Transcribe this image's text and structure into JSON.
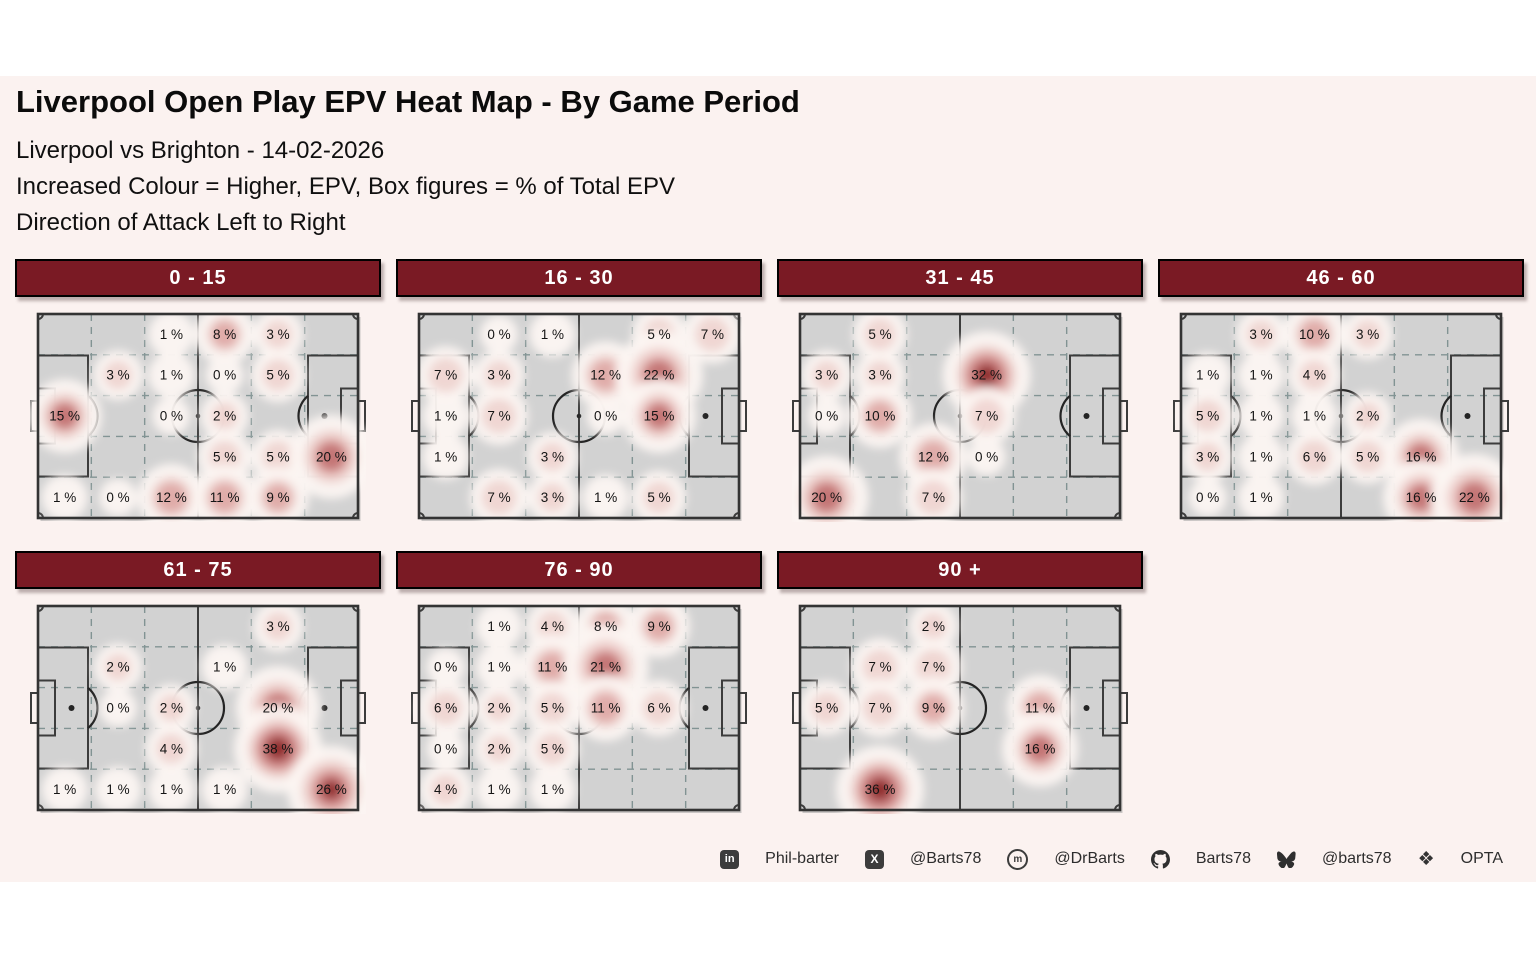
{
  "colors": {
    "page_bg": "#ffffff",
    "figure_bg": "#fbf2f0",
    "header_bar_bg": "#7a1a24",
    "header_bar_border": "#000000",
    "header_text": "#ffffff",
    "pitch_fill": "#d2d2d2",
    "pitch_border": "#333333",
    "pitch_marking": "#3c3c3c",
    "center_circle": "#242424",
    "grid_line": "#7d9090",
    "label_text": "#141414",
    "heat_halo": "#fcf5f2",
    "heat_light": "#edcfcc",
    "heat_mid": "#dda5a2",
    "heat_strong": "#c17070",
    "heat_core": "#8f2b2b"
  },
  "header": {
    "title": "Liverpool Open Play EPV Heat Map - By Game Period",
    "subtitle_lines": [
      "Liverpool vs Brighton - 14-02-2026",
      "Increased Colour = Higher, EPV, Box figures = % of Total EPV",
      "Direction of Attack Left to Right"
    ]
  },
  "chart_data": {
    "type": "heatmap",
    "unit": "% of Total EPV",
    "grid": {
      "cols": 6,
      "rows": 5
    },
    "direction_of_attack": "left to right",
    "panels": [
      {
        "period": "0 - 15",
        "cells": [
          [
            null,
            null,
            1,
            8,
            3,
            null
          ],
          [
            null,
            3,
            1,
            0,
            5,
            null
          ],
          [
            15,
            null,
            0,
            2,
            null,
            null
          ],
          [
            null,
            null,
            null,
            5,
            5,
            20
          ],
          [
            1,
            0,
            12,
            11,
            9,
            null
          ]
        ]
      },
      {
        "period": "16 - 30",
        "cells": [
          [
            null,
            0,
            1,
            null,
            5,
            7
          ],
          [
            7,
            3,
            null,
            12,
            22,
            null
          ],
          [
            1,
            7,
            null,
            0,
            15,
            null
          ],
          [
            1,
            null,
            3,
            null,
            null,
            null
          ],
          [
            null,
            7,
            3,
            1,
            5,
            null
          ]
        ]
      },
      {
        "period": "31 - 45",
        "cells": [
          [
            null,
            5,
            null,
            null,
            null,
            null
          ],
          [
            3,
            3,
            null,
            32,
            null,
            null
          ],
          [
            0,
            10,
            null,
            7,
            null,
            null
          ],
          [
            null,
            null,
            12,
            0,
            null,
            null
          ],
          [
            20,
            null,
            7,
            null,
            null,
            null
          ]
        ]
      },
      {
        "period": "46 - 60",
        "cells": [
          [
            null,
            3,
            10,
            3,
            null,
            null
          ],
          [
            1,
            1,
            4,
            null,
            null,
            null
          ],
          [
            5,
            1,
            1,
            2,
            null,
            null
          ],
          [
            3,
            1,
            6,
            5,
            16,
            null
          ],
          [
            0,
            1,
            null,
            null,
            16,
            22
          ]
        ]
      },
      {
        "period": "61 - 75",
        "cells": [
          [
            null,
            null,
            null,
            null,
            3,
            null
          ],
          [
            null,
            2,
            null,
            1,
            null,
            null
          ],
          [
            null,
            0,
            2,
            null,
            20,
            null
          ],
          [
            null,
            null,
            4,
            null,
            38,
            null
          ],
          [
            1,
            1,
            1,
            1,
            null,
            26
          ]
        ]
      },
      {
        "period": "76 - 90",
        "cells": [
          [
            null,
            1,
            4,
            8,
            9,
            null
          ],
          [
            0,
            1,
            11,
            21,
            null,
            null
          ],
          [
            6,
            2,
            5,
            11,
            6,
            null
          ],
          [
            0,
            2,
            5,
            null,
            null,
            null
          ],
          [
            4,
            1,
            1,
            null,
            null,
            null
          ]
        ]
      },
      {
        "period": "90 +",
        "cells": [
          [
            null,
            null,
            2,
            null,
            null,
            null
          ],
          [
            null,
            7,
            7,
            null,
            null,
            null
          ],
          [
            5,
            7,
            9,
            null,
            11,
            null
          ],
          [
            null,
            null,
            null,
            null,
            16,
            null
          ],
          [
            null,
            36,
            null,
            null,
            null,
            null
          ]
        ]
      }
    ]
  },
  "footer": {
    "items": [
      {
        "icon": "linkedin-icon",
        "label": "Phil-barter"
      },
      {
        "icon": "x-icon",
        "label": "@Barts78"
      },
      {
        "icon": "mastodon-icon",
        "label": "@DrBarts"
      },
      {
        "icon": "github-icon",
        "label": "Barts78"
      },
      {
        "icon": "bluesky-icon",
        "label": "@barts78"
      },
      {
        "icon": "dropbox-icon",
        "label": "OPTA"
      }
    ]
  }
}
